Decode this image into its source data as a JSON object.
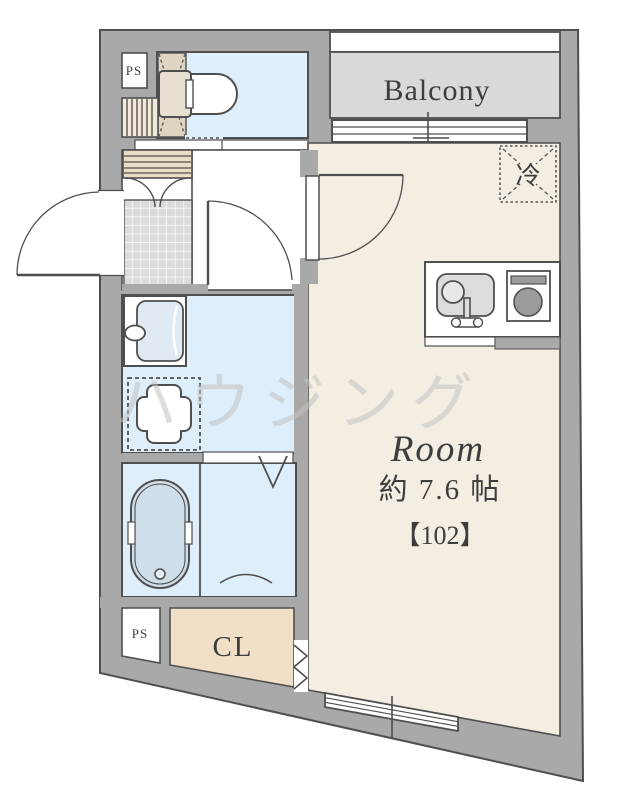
{
  "plan": {
    "type": "apartment-floor-plan",
    "labels": {
      "balcony": "Balcony",
      "fridge": "冷",
      "room_name": "Room",
      "room_size": "約 7.6 帖",
      "room_number": "【102】",
      "closet": "CL",
      "ps_top": "PS",
      "ps_bottom": "PS",
      "watermark": "ハウジング"
    },
    "fixtures": [
      "toilet-icon",
      "shoe-cabinet-icon",
      "entrance-tile-floor",
      "entrance-door-swing",
      "hall-washroom-door-swing",
      "room-door-swing",
      "vanity-basin-icon",
      "washing-machine-pan-icon",
      "bathtub-icon",
      "bathroom-folding-door-icon",
      "closet-accordion-door-icon",
      "kitchen-sink-icon",
      "stove-burner-icon",
      "refrigerator-space-icon",
      "balcony-sliding-window-icon",
      "south-sliding-window-icon"
    ],
    "colors": {
      "wall": "#a9a9a9",
      "outline": "#4f4f4f",
      "room_floor": "#f3eee1",
      "wet_floor": "#deeefa",
      "balcony_floor": "#d9d9d9",
      "closet_floor": "#f2dfc8",
      "tub_fill": "#cfdfe9",
      "tile_floor": "#dbdbdb",
      "cabinet_fill": "#e9ddc8",
      "hatch_strip": "#ddd4c1"
    }
  }
}
